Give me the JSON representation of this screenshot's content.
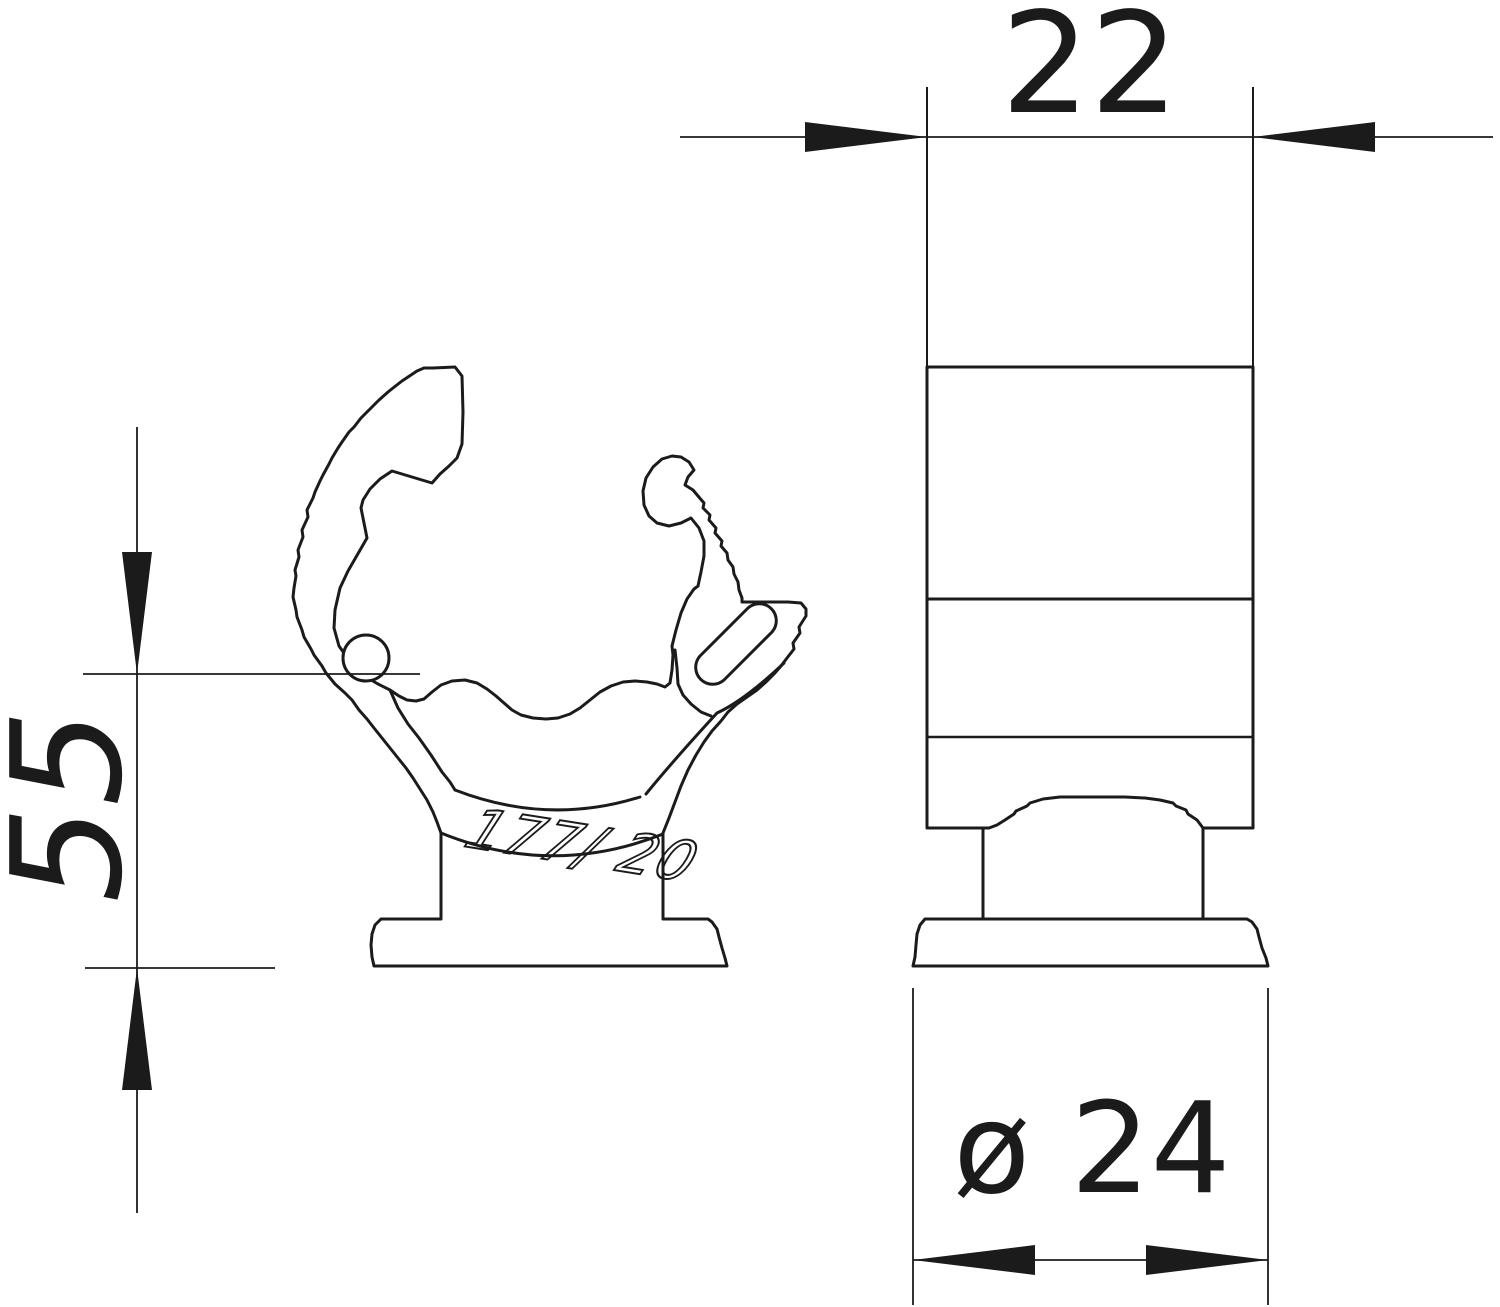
{
  "colors": {
    "line": "#1b1b1b",
    "background": "#ffffff"
  },
  "dimensions": {
    "width": {
      "value": "22",
      "orientation": "horizontal-top"
    },
    "height": {
      "value": "55",
      "orientation": "vertical-left"
    },
    "diameter": {
      "value": "ø 24",
      "orientation": "horizontal-bottom"
    }
  },
  "part": {
    "marking": "177/ 20"
  }
}
